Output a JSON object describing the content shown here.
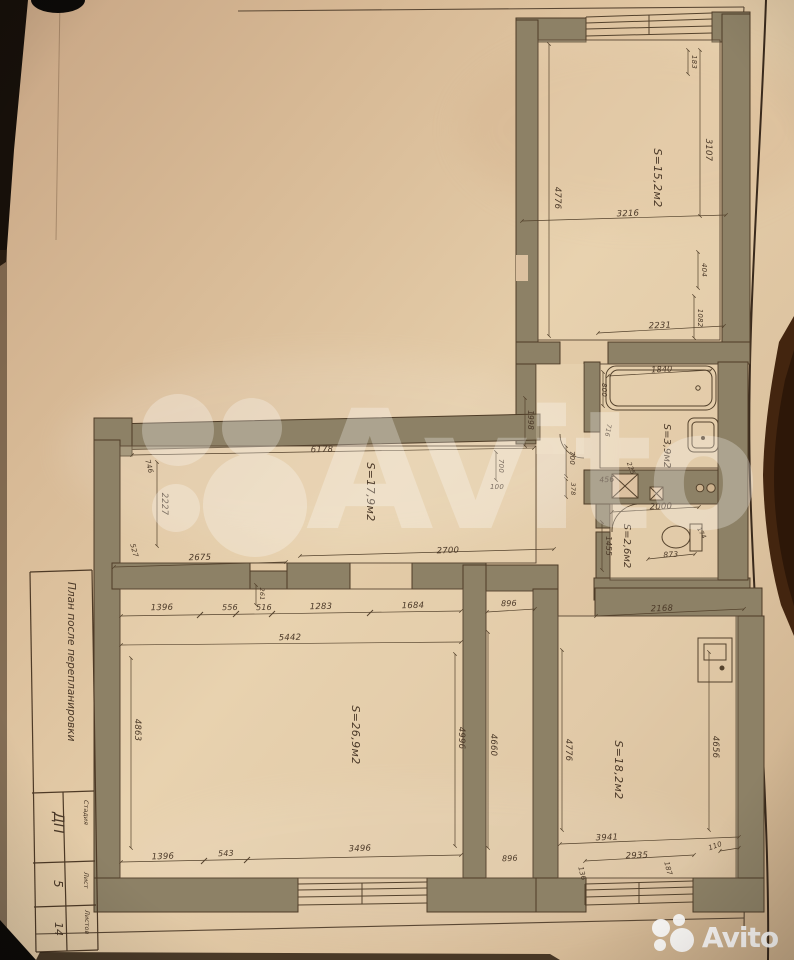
{
  "page": {
    "kind": "Photographed apartment floor plan (listing image)"
  },
  "colors": {
    "paper": "#dcc0a0",
    "wall_fill": "#8d8166",
    "line": "#54422c",
    "dim_text": "#4b3928",
    "background": "#0d0a07",
    "wood_edge": "#43250f",
    "watermark": "#ffffff"
  },
  "watermark": {
    "brand": "Avito"
  },
  "footer_logo": {
    "brand": "Avito"
  },
  "title_block": {
    "plan_title": "План после перепланировки",
    "stage_label": "Стадия",
    "stage_value": "ДП",
    "sheet_label": "Лист",
    "sheet_value": "5",
    "sheets_label": "Листов",
    "sheets_value": "14"
  },
  "rooms": {
    "top_room": {
      "area": "S=15,2м2"
    },
    "bathroom": {
      "area": "S=3,9м2"
    },
    "wc": {
      "area": "S=2,6м2"
    },
    "hallway": {
      "area": "S=17,9м2"
    },
    "living_room": {
      "area": "S=26,9м2"
    },
    "right_room": {
      "area": "S=18,2м2"
    }
  },
  "dims": {
    "d100": "100",
    "d110": "110",
    "d136": "136",
    "d174": "174",
    "d183": "183",
    "d187": "187",
    "d225": "225",
    "d261": "261",
    "d378": "378",
    "d404": "404",
    "d456": "456",
    "d516": "516",
    "d527": "527",
    "d543": "543",
    "d556": "556",
    "d700": "700",
    "d716": "716",
    "d746": "746",
    "d800": "800",
    "d873": "873",
    "d896": "896",
    "d1082": "1082",
    "d1283": "1283",
    "d1396": "1396",
    "d1455": "1455",
    "d1684": "1684",
    "d1840": "1840",
    "d1998": "1998",
    "d2000": "2000",
    "d2168": "2168",
    "d2227": "2227",
    "d2231": "2231",
    "d2675": "2675",
    "d2700": "2700",
    "d2935": "2935",
    "d3107": "3107",
    "d3216": "3216",
    "d3496": "3496",
    "d3941": "3941",
    "d4656": "4656",
    "d4660": "4660",
    "d4776": "4776",
    "d4863": "4863",
    "d4996": "4996",
    "d5442": "5442",
    "d6178": "6178"
  }
}
